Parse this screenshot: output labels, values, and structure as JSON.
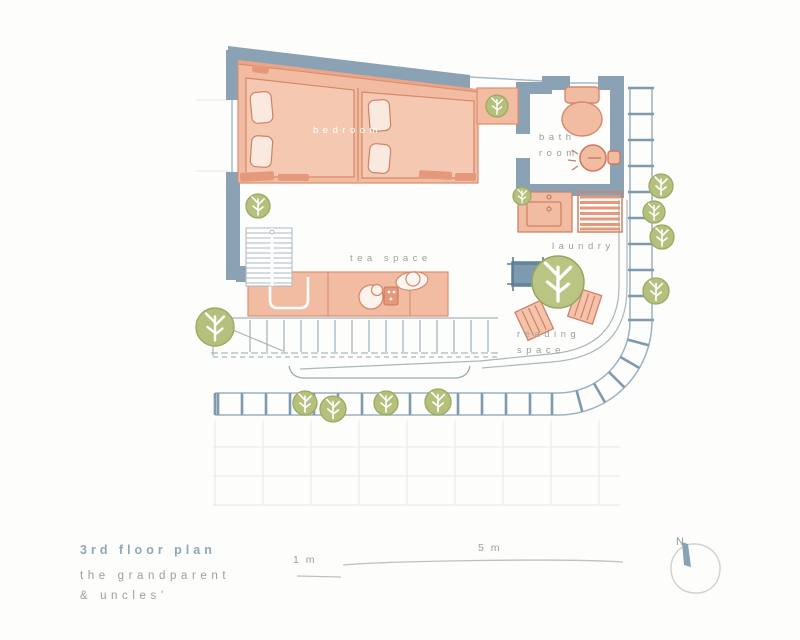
{
  "title": {
    "heading": "3rd floor plan",
    "subtitle_line1": "the grandparent",
    "subtitle_line2": "& uncles'"
  },
  "rooms": {
    "bedroom": "bedroom",
    "bath_line1": "bath",
    "bath_line2": "room",
    "laundry": "laundry",
    "tea_space": "tea space",
    "reading_line1": "reading",
    "reading_line2": "space"
  },
  "scale": {
    "small": "1 m",
    "large": "5 m"
  },
  "compass": {
    "north_label": "N"
  },
  "colors": {
    "wall": "#8aa2b3",
    "room_fill": "#f2bca3",
    "room_fill_light": "#f5c9b1",
    "room_stroke": "#dd8e6e",
    "accent_salmon_dark": "#e5987a",
    "tree_fill": "#b6c07d",
    "tree_stroke": "#9aa961",
    "trellis_rung": "#7e9ab0",
    "thin_line": "#a9b6ba",
    "label_gray": "#9aa09d",
    "heading_blue": "#90a8b5"
  }
}
